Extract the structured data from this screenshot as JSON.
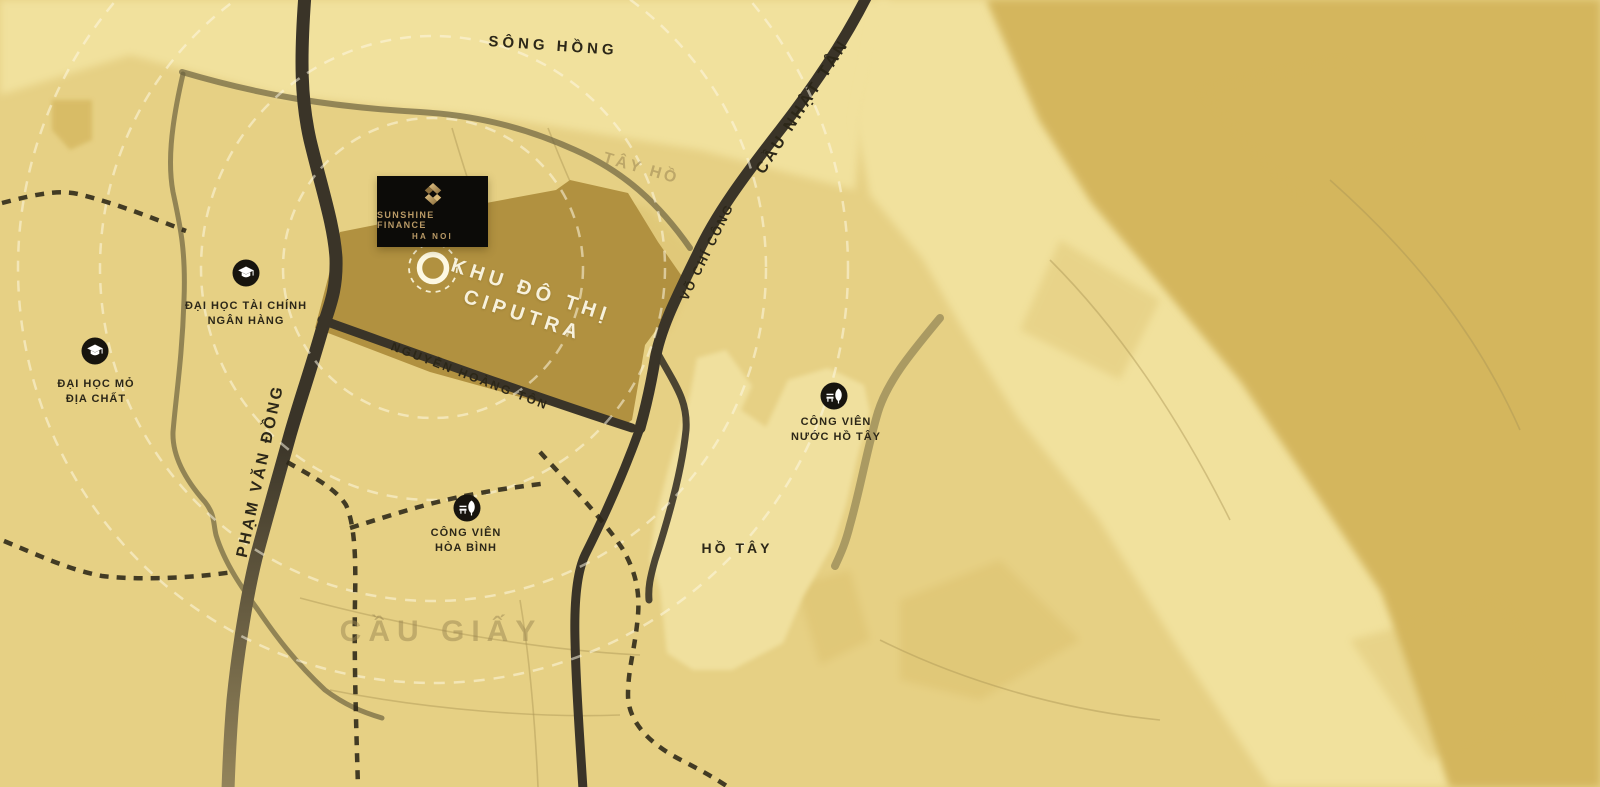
{
  "title": "Sunshine Finance Ha Noi — location map",
  "colors": {
    "river_light": "#f1e19d",
    "land_gold": "#e6d084",
    "east_bank": "#d4b65d",
    "ciputra_gold": "#b19140",
    "lake_light": "#f0e09e",
    "road_dark": "#3a3428",
    "road_olive": "#6e6440",
    "dashed_road": "#2b2617",
    "ring_white": "#fdf8e2",
    "label_dark": "#2c2718",
    "faded_label": "#9c8752",
    "logo_bg": "#0c0b08",
    "logo_gold": "#b99a66",
    "poi_bg": "#17140e"
  },
  "project": {
    "logo_line1": "SUNSHINE FINANCE",
    "logo_line2": "HA NOI",
    "area_line1": "KHU ĐÔ THỊ",
    "area_line2": "CIPUTRA"
  },
  "map_labels": {
    "river": "SÔNG HỒNG",
    "bridge": "CẦU NHẬT TÂN",
    "district_tay_ho": "TÂY HỒ",
    "road_vo_chi_cong": "VÕ CHÍ CÔNG",
    "road_pham_van_dong": "PHẠM VĂN ĐỒNG",
    "road_nguyen_hoang_ton": "NGUYỄN HOÀNG TÔN",
    "lake": "HỒ TÂY",
    "district_cau_giay": "CẦU GIẤY"
  },
  "landmarks": [
    {
      "id": "dai-hoc-tai-chinh",
      "icon": "graduation-cap",
      "line1": "ĐẠI HỌC TÀI CHÍNH",
      "line2": "NGÂN HÀNG"
    },
    {
      "id": "dai-hoc-mo",
      "icon": "graduation-cap",
      "line1": "ĐẠI HỌC MỎ",
      "line2": "ĐỊA CHẤT"
    },
    {
      "id": "cong-vien-nuoc",
      "icon": "park-tree",
      "line1": "CÔNG VIÊN",
      "line2": "NƯỚC HỒ TÂY"
    },
    {
      "id": "cong-vien-hoa-binh",
      "icon": "park-tree",
      "line1": "CÔNG VIÊN",
      "line2": "HÒA BÌNH"
    }
  ]
}
